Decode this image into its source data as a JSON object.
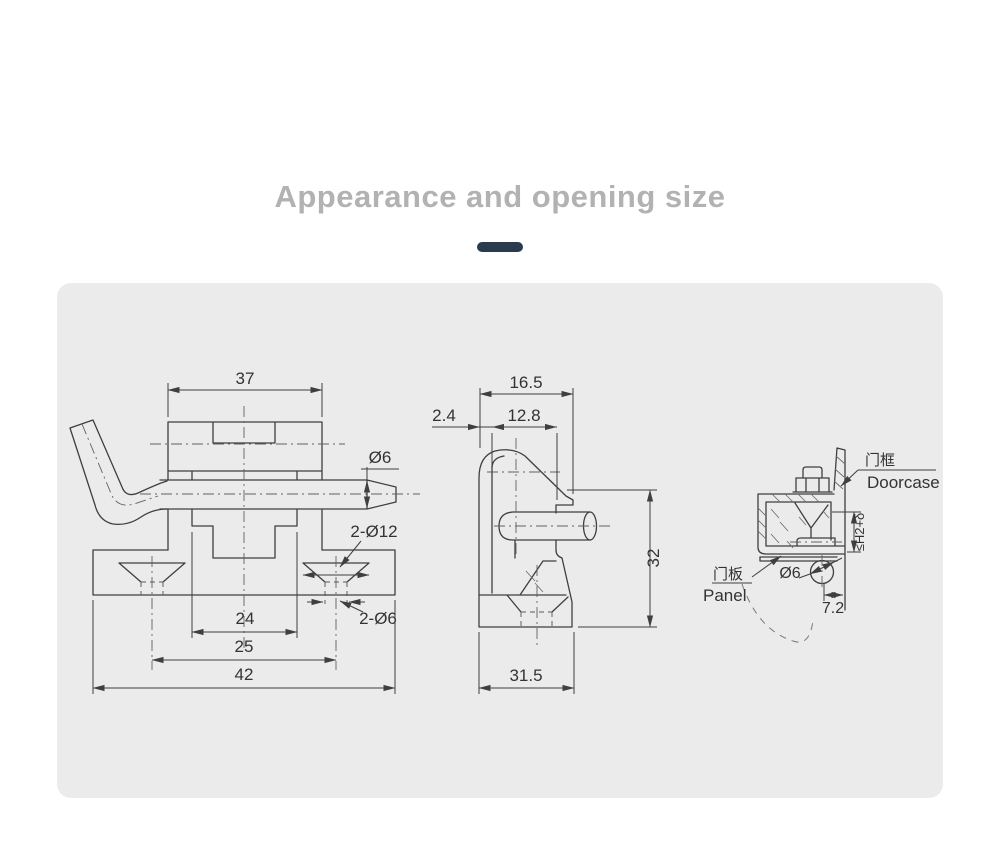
{
  "page": {
    "title": "Appearance and opening size"
  },
  "theme": {
    "accent_color": "#2b3b4e",
    "panel_color": "#ebebeb",
    "line_color": "#3f3f3f",
    "title_color": "#b2b2b2",
    "dim_text_color": "#333333"
  },
  "front_view": {
    "width_top": "37",
    "pin_diameter": "Ø6",
    "countersunk_holes": "2-Ø12",
    "through_holes": "2-Ø6",
    "slot_width": "24",
    "hole_spacing": "25",
    "base_width": "42"
  },
  "side_view": {
    "top_width": "16.5",
    "lip_thickness": "2.4",
    "opening_width": "12.8",
    "height": "32",
    "base_depth": "31.5"
  },
  "install_view": {
    "doorcase_cn": "门框",
    "doorcase_en": "Doorcase",
    "clearance": "≤H2+δ",
    "pin_diameter": "Ø6",
    "panel_cn": "门板",
    "panel_en": "Panel",
    "edge_distance": "7.2"
  }
}
